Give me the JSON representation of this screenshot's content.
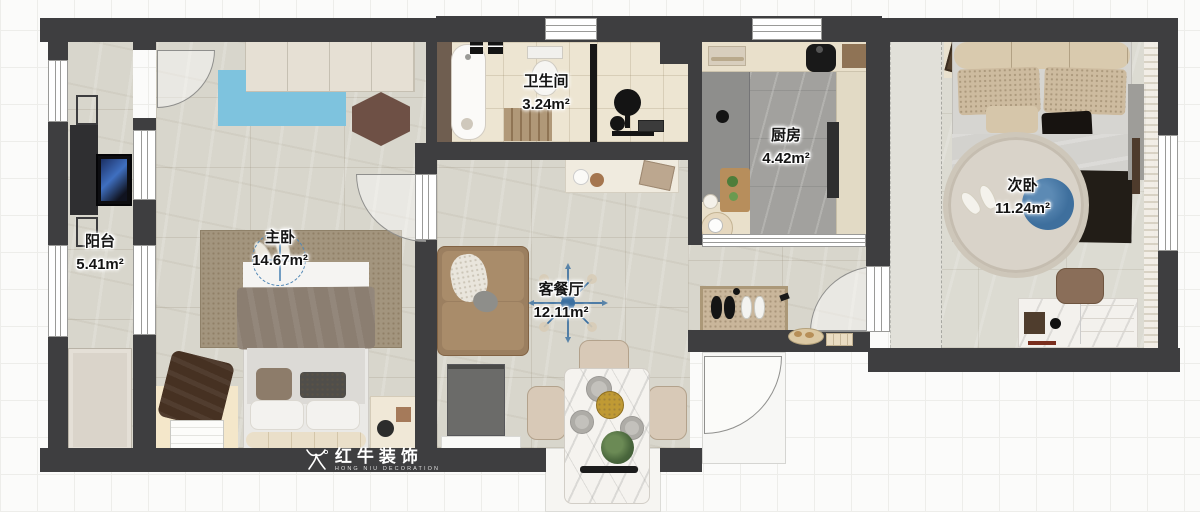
{
  "plan": {
    "rooms": {
      "balcony": {
        "name": "阳台",
        "area": "5.41m²"
      },
      "master_bedroom": {
        "name": "主卧",
        "area": "14.67m²"
      },
      "bathroom": {
        "name": "卫生间",
        "area": "3.24m²"
      },
      "kitchen": {
        "name": "厨房",
        "area": "4.42m²"
      },
      "living_dining": {
        "name": "客餐厅",
        "area": "12.11m²"
      },
      "second_bedroom": {
        "name": "次卧",
        "area": "11.24m²"
      }
    }
  },
  "logo": {
    "brand_cn": "红牛装饰",
    "brand_en": "HONG NIU DECORATION"
  },
  "colors": {
    "wall": "#3e3e40",
    "floor_marble": "#d8d6cc",
    "floor_bath": "#ede5d2",
    "floor_kitchen": "#a2a19e",
    "rug_blue": "#7ec3de",
    "fan_blue": "#3e6f9d",
    "logo_text": "#ffffff"
  }
}
